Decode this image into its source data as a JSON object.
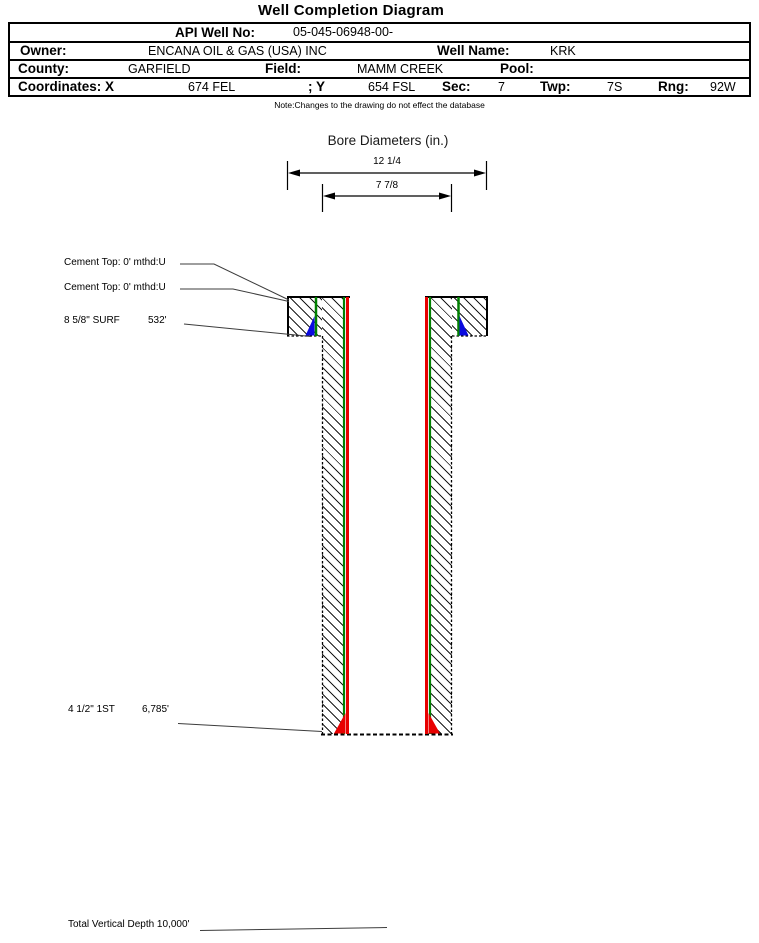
{
  "page_title": "Well Completion Diagram",
  "header_table": {
    "api": {
      "label": "API Well No:",
      "value": "05-045-06948-00-"
    },
    "owner": {
      "label": "Owner:",
      "value": "ENCANA OIL & GAS (USA) INC"
    },
    "well_name": {
      "label": "Well Name:",
      "value": "KRK"
    },
    "county": {
      "label": "County:",
      "value": "GARFIELD"
    },
    "field": {
      "label": "Field:",
      "value": "MAMM CREEK"
    },
    "pool": {
      "label": "Pool:",
      "value": ""
    },
    "coordinates": {
      "label": "Coordinates: X",
      "x_value": "674 FEL",
      "y_label": "; Y",
      "y_value": "654 FSL"
    },
    "sec": {
      "label": "Sec:",
      "value": "7"
    },
    "twp": {
      "label": "Twp:",
      "value": "7S"
    },
    "rng": {
      "label": "Rng:",
      "value": "92W"
    }
  },
  "note": "Note:Changes to the drawing do not effect the database",
  "bore_diameters": {
    "title": "Bore Diameters (in.)",
    "outer_label": "12 1/4",
    "inner_label": "7 7/8"
  },
  "annotations": {
    "cement_top_1": "Cement Top: 0' mthd:U",
    "cement_top_2": "Cement Top: 0' mthd:U",
    "surface_casing": {
      "label": "8 5/8\" SURF",
      "depth": "532'"
    },
    "production_casing": {
      "label": "4 1/2\" 1ST",
      "depth": "6,785'"
    },
    "total_vertical_depth": "Total Vertical Depth 10,000'"
  },
  "colors": {
    "casing_green": "#008000",
    "casing_red": "#e80000",
    "cement_blue": "#0a0adf",
    "hatch_black": "#1a1a1a"
  }
}
